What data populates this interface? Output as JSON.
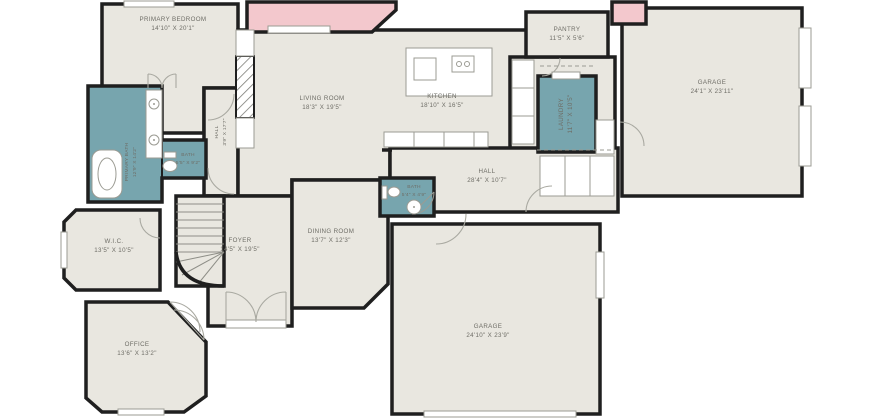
{
  "plan": {
    "type": "residential-floor-plan",
    "colors": {
      "wall": "#1f1f1f",
      "floor": "#e9e7e0",
      "wet_room": "#77a5ae",
      "accent_room": "#f3c8cd",
      "label_text": "#6e6d66",
      "fixture_stroke": "#9b9b93",
      "background": "#ffffff"
    },
    "rooms": [
      {
        "id": "primary-bedroom",
        "name": "PRIMARY BEDROOM",
        "dims": "14'10\" X 20'1\""
      },
      {
        "id": "pantry",
        "name": "PANTRY",
        "dims": "11'5\" X 5'6\""
      },
      {
        "id": "garage-right",
        "name": "GARAGE",
        "dims": "24'1\" X 23'11\""
      },
      {
        "id": "living-room",
        "name": "LIVING ROOM",
        "dims": "18'3\" X 19'5\""
      },
      {
        "id": "kitchen",
        "name": "KITCHEN",
        "dims": "18'10\" X 16'5\""
      },
      {
        "id": "laundry",
        "name": "LAUNDRY",
        "dims": "11'7\" X 10'5\""
      },
      {
        "id": "hall-upper",
        "name": "HALL",
        "dims": "3'9\" X 17'7\""
      },
      {
        "id": "primary-bath",
        "name": "PRIMARY BATH",
        "dims": "12'9\" X 14'2\""
      },
      {
        "id": "primary-water-closet",
        "name": "BATH",
        "dims": "5'5\" X 9'2\""
      },
      {
        "id": "hall-main",
        "name": "HALL",
        "dims": "28'4\" X 10'7\""
      },
      {
        "id": "hall-bath",
        "name": "BATH",
        "dims": "5'4\" X 4'9\""
      },
      {
        "id": "wic",
        "name": "W.I.C.",
        "dims": "13'5\" X 10'5\""
      },
      {
        "id": "foyer",
        "name": "FOYER",
        "dims": "14'5\" X 19'5\""
      },
      {
        "id": "dining-room",
        "name": "DINING ROOM",
        "dims": "13'7\" X 12'3\""
      },
      {
        "id": "garage-bottom",
        "name": "GARAGE",
        "dims": "24'10\" X 23'9\""
      },
      {
        "id": "office",
        "name": "OFFICE",
        "dims": "13'6\" X 13'2\""
      }
    ]
  }
}
